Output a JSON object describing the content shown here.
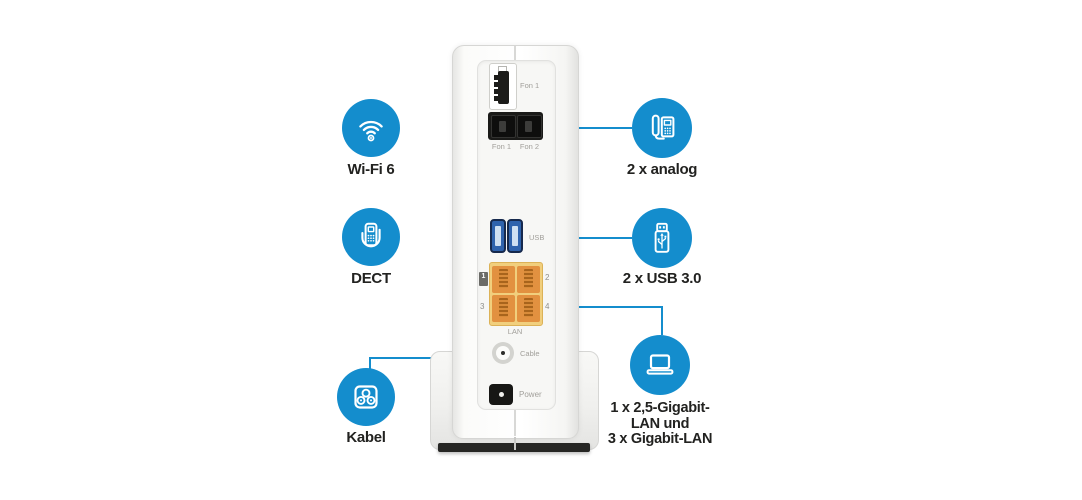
{
  "colors": {
    "accent_blue": "#148dcd",
    "label_text": "#222220",
    "router_port_label": "#a19f9a",
    "lan_port_orange": "#e29140",
    "usb_port_blue": "#2f63ad"
  },
  "callouts": {
    "wifi": {
      "label": "Wi-Fi 6",
      "icon": "wifi-icon"
    },
    "dect": {
      "label": "DECT",
      "icon": "dect-phone-icon"
    },
    "kabel": {
      "label": "Kabel",
      "icon": "cable-socket-icon"
    },
    "analog": {
      "label": "2 x analog",
      "icon": "analog-phone-icon"
    },
    "usb": {
      "label": "2 x USB 3.0",
      "icon": "usb-stick-icon"
    },
    "lan": {
      "label_line1": "1 x 2,5-Gigabit-",
      "label_line2": "LAN und",
      "label_line3": "3 x Gigabit-LAN",
      "icon": "laptop-icon"
    }
  },
  "router": {
    "tae_label": "Fon 1",
    "rj11_label_1": "Fon 1",
    "rj11_label_2": "Fon 2",
    "usb_label": "USB",
    "lan_label": "LAN",
    "lan_port_1": "1",
    "lan_port_2": "2",
    "lan_port_3": "3",
    "lan_port_4": "4",
    "cable_label": "Cable",
    "power_label": "Power"
  }
}
